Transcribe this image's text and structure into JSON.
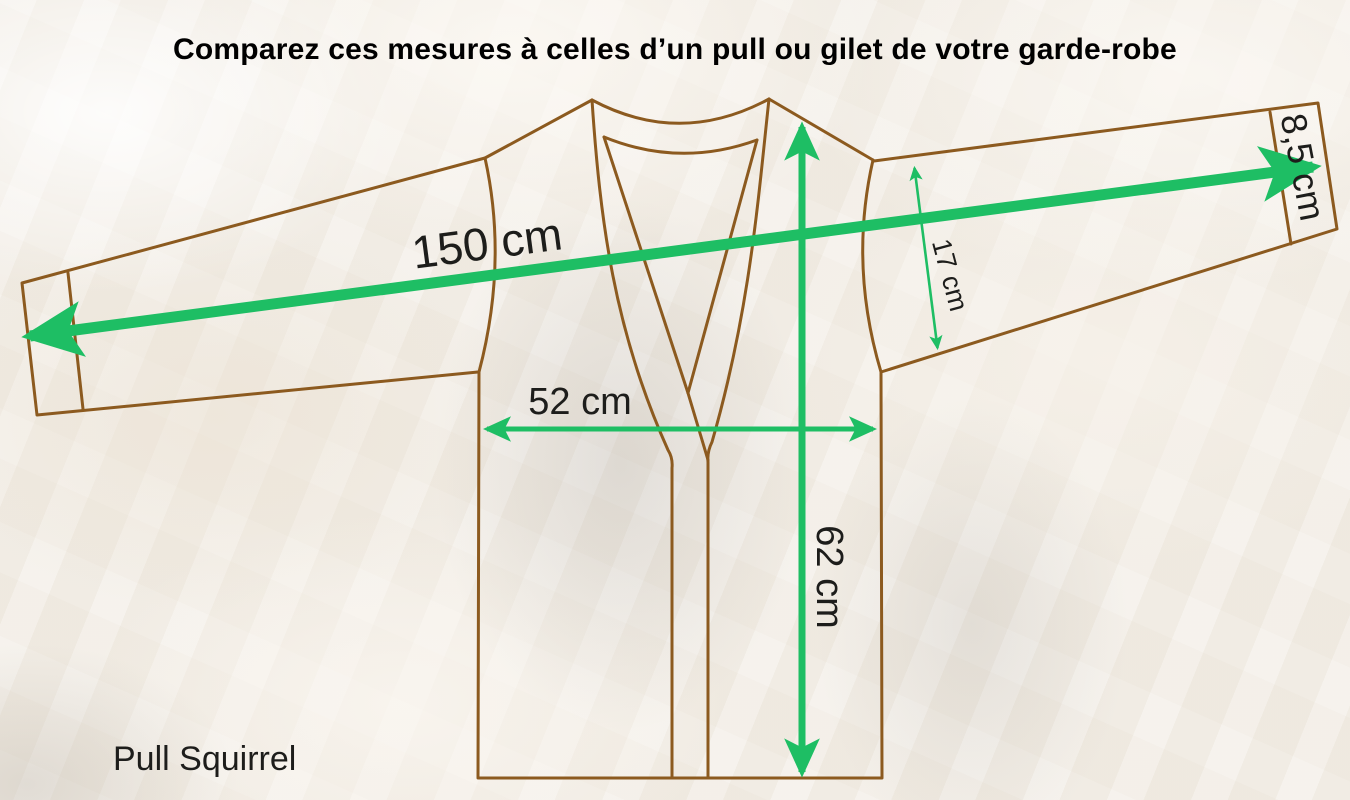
{
  "title": "Comparez ces mesures à celles d’un pull ou gilet de votre garde-robe",
  "product_label": "Pull Squirrel",
  "measurements": {
    "wingspan": "150 cm",
    "chest_width": "52 cm",
    "body_length": "62 cm",
    "sleeve_width_armhole": "17 cm",
    "cuff_height": "8,5 cm"
  },
  "colors": {
    "garment_outline": "#8C5A1F",
    "arrow_green": "#1EBE64",
    "label_text": "#1D1D1B",
    "title_text": "#000000",
    "background_base": "#F1ECE4"
  }
}
